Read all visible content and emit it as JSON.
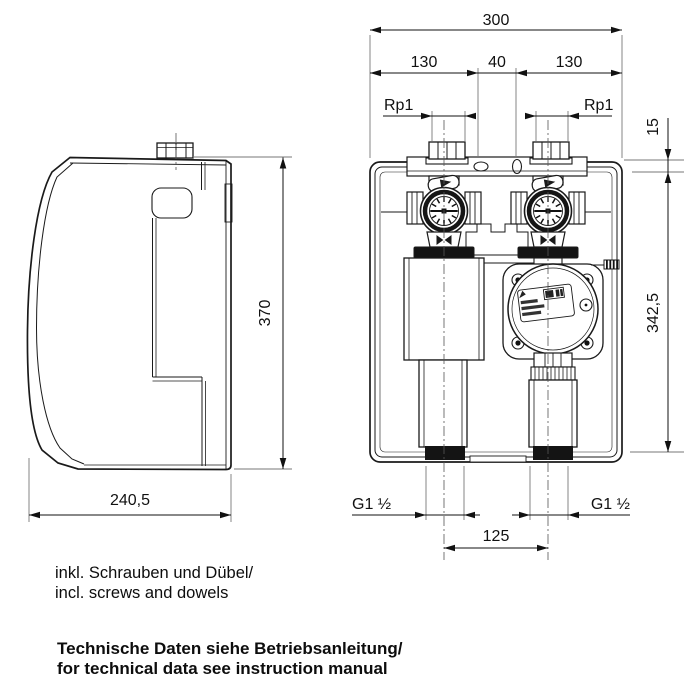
{
  "drawing": {
    "title": "pump-group-dimension-drawing",
    "dimensions": {
      "overall_width": "300",
      "offset_left": "130",
      "center_gap": "40",
      "offset_right": "130",
      "thread_top_left": "Rp1",
      "thread_top_right": "Rp1",
      "top_inset": "15",
      "body_height": "342,5",
      "side_height": "370",
      "side_depth": "240,5",
      "thread_bottom_left": "G1 ½",
      "thread_bottom_right": "G1 ½",
      "pipe_spacing": "125"
    },
    "notes": {
      "included_de": "inkl. Schrauben und Dübel/",
      "included_en": "incl. screws and dowels",
      "tech_de": "Technische Daten siehe Betriebsanleitung/",
      "tech_en": "for technical data see instruction manual"
    },
    "colors": {
      "line": "#1a1a1a",
      "background": "#ffffff",
      "band": "#141414",
      "thin_line": "#777777"
    }
  }
}
